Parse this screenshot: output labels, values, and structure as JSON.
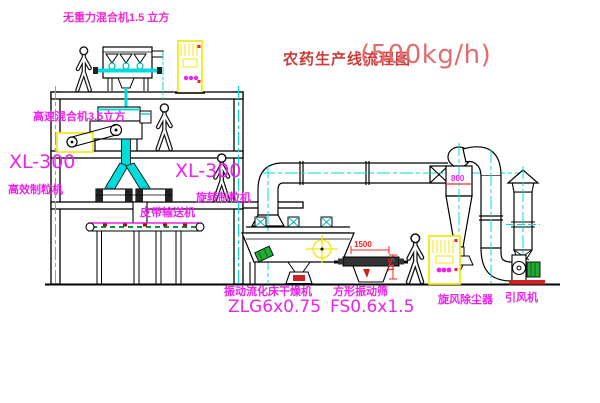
{
  "title": {
    "name_cn": "农药生产线流程图",
    "capacity": "(500kg/h)"
  },
  "equipment_labels": {
    "weightless_mixer": "无重力混合机1.5 立方",
    "high_speed_mixer": "高速混合机3.5立方",
    "granulator_left_model": "XL-300",
    "granulator_left_name": "高效制粒机",
    "granulator_right_model": "XL-300",
    "granulator_right_name": "旋转制粒机",
    "belt_conveyor": "皮带输送机",
    "fluid_bed_dryer_name": "振动流化床干燥机",
    "fluid_bed_dryer_model": "ZLG6x0.75",
    "vibrating_sieve_name": "方形振动筛",
    "vibrating_sieve_model": "FS0.6x1.5",
    "cyclone_dust_collector": "旋风除尘器",
    "induced_draft_fan": "引风机"
  },
  "dimensions": {
    "sieve_length": "1500",
    "sieve_height": "541",
    "cyclone_diameter": "800"
  },
  "colors": {
    "label_magenta": "#ee22ee",
    "title_red": "#cd3b3b",
    "cad_cyan": "#00dcdc",
    "cabinet_yellow": "#f2e70a",
    "dimension_red": "#ff2222",
    "motor_green": "#22aa33"
  }
}
